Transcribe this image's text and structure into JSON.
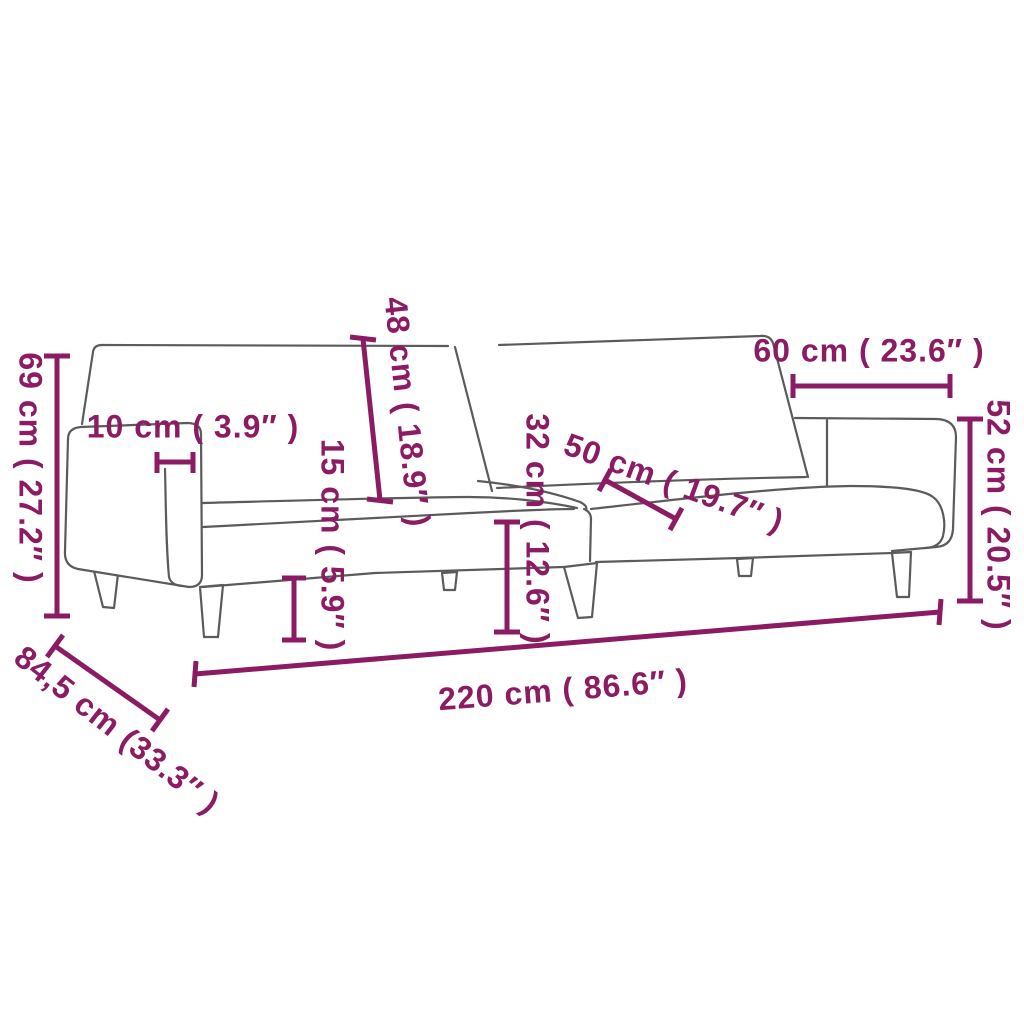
{
  "diagram": {
    "subject": "2-seater sofa bed line drawing with dimensions",
    "colors": {
      "dimension_text": "#8b1b63",
      "outline": "#5b5b5b",
      "background": "#ffffff"
    },
    "dimensions": {
      "d69": {
        "label": "69 cm ( 27.2″ )"
      },
      "d10": {
        "label": "10 cm ( 3.9″ )"
      },
      "d48": {
        "label": "48 cm ( 18.9″ )"
      },
      "d15": {
        "label": "15 cm ( 5.9″ )"
      },
      "d32": {
        "label": "32 cm ( 12.6″ )"
      },
      "d50": {
        "label": "50 cm ( 19.7″ )"
      },
      "d60": {
        "label": "60 cm ( 23.6″ )"
      },
      "d52": {
        "label": "52 cm ( 20.5″ )"
      },
      "d220": {
        "label": "220 cm ( 86.6″ )"
      },
      "d845": {
        "label": "84,5 cm (33.3″ )"
      }
    }
  }
}
